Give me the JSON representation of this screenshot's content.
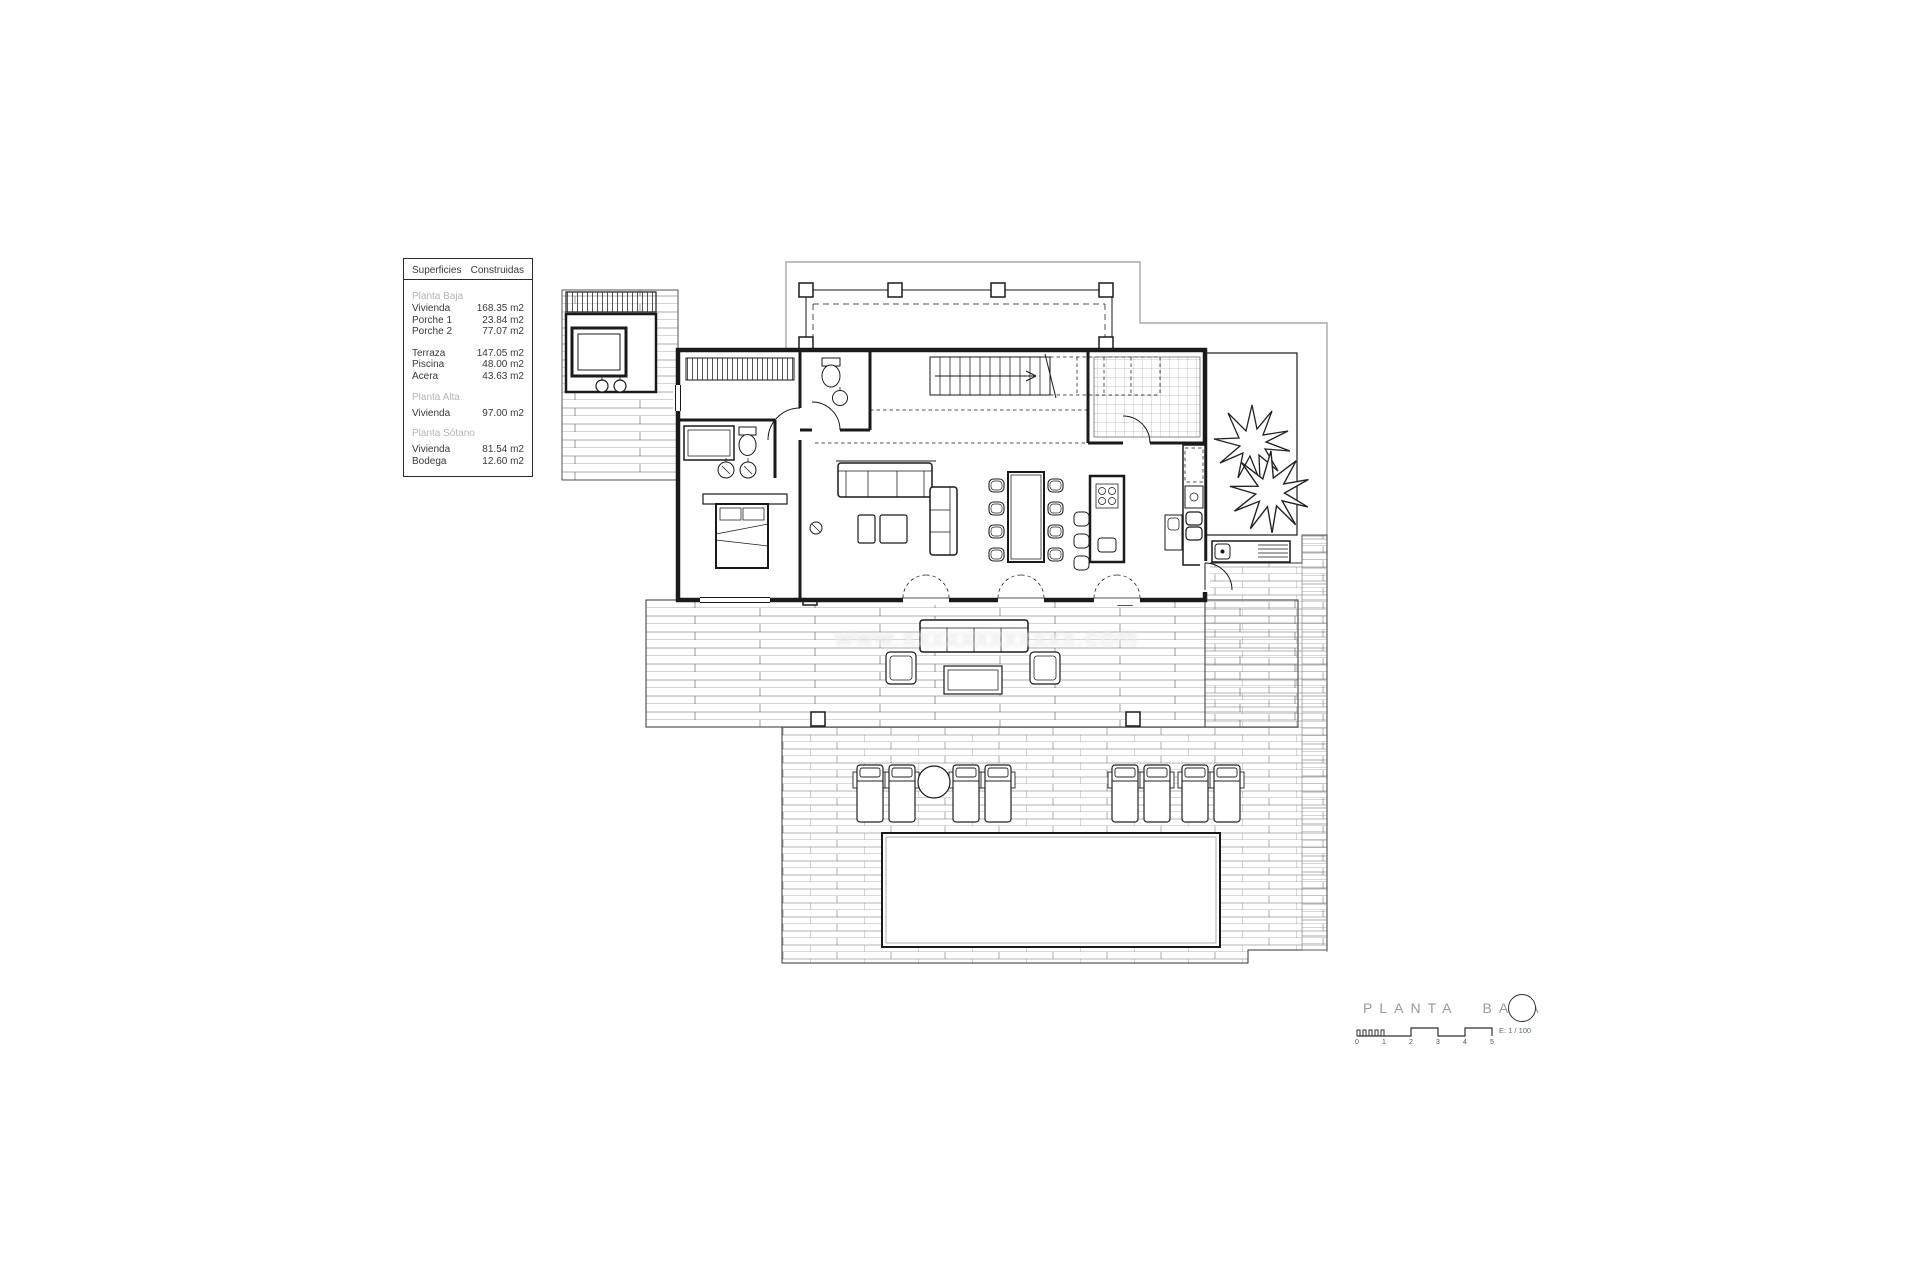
{
  "surfaces_table": {
    "header": {
      "col1": "Superficies",
      "col2": "Construidas"
    },
    "sections": [
      {
        "title": "Planta Baja",
        "rows": [
          {
            "label": "Vivienda",
            "value": "168.35 m2"
          },
          {
            "label": "Porche 1",
            "value": "23.84 m2"
          },
          {
            "label": "Porche 2",
            "value": "77.07 m2"
          },
          {
            "label": "Terraza",
            "value": "147.05 m2"
          },
          {
            "label": "Piscina",
            "value": "48.00 m2"
          },
          {
            "label": "Acera",
            "value": "43.63 m2"
          }
        ]
      },
      {
        "title": "Planta Alta",
        "rows": [
          {
            "label": "Vivienda",
            "value": "97.00 m2"
          }
        ]
      },
      {
        "title": "Planta Sótano",
        "rows": [
          {
            "label": "Vivienda",
            "value": "81.54 m2"
          },
          {
            "label": "Bodega",
            "value": "12.60 m2"
          }
        ]
      }
    ]
  },
  "title_block": {
    "title": "PLANTA BAJA",
    "scale_label": "E: 1 / 100",
    "scale_ticks": [
      "0",
      "1",
      "2",
      "3",
      "4",
      "5"
    ]
  },
  "watermark": {
    "text": "www.xxxxxxxxxxxx.com"
  },
  "colors": {
    "line": "#1a1a1a",
    "site_boundary_gray": "#a9a9a9",
    "muted_table_text": "#b4b4b4",
    "title_gray": "#9a9a9a"
  }
}
